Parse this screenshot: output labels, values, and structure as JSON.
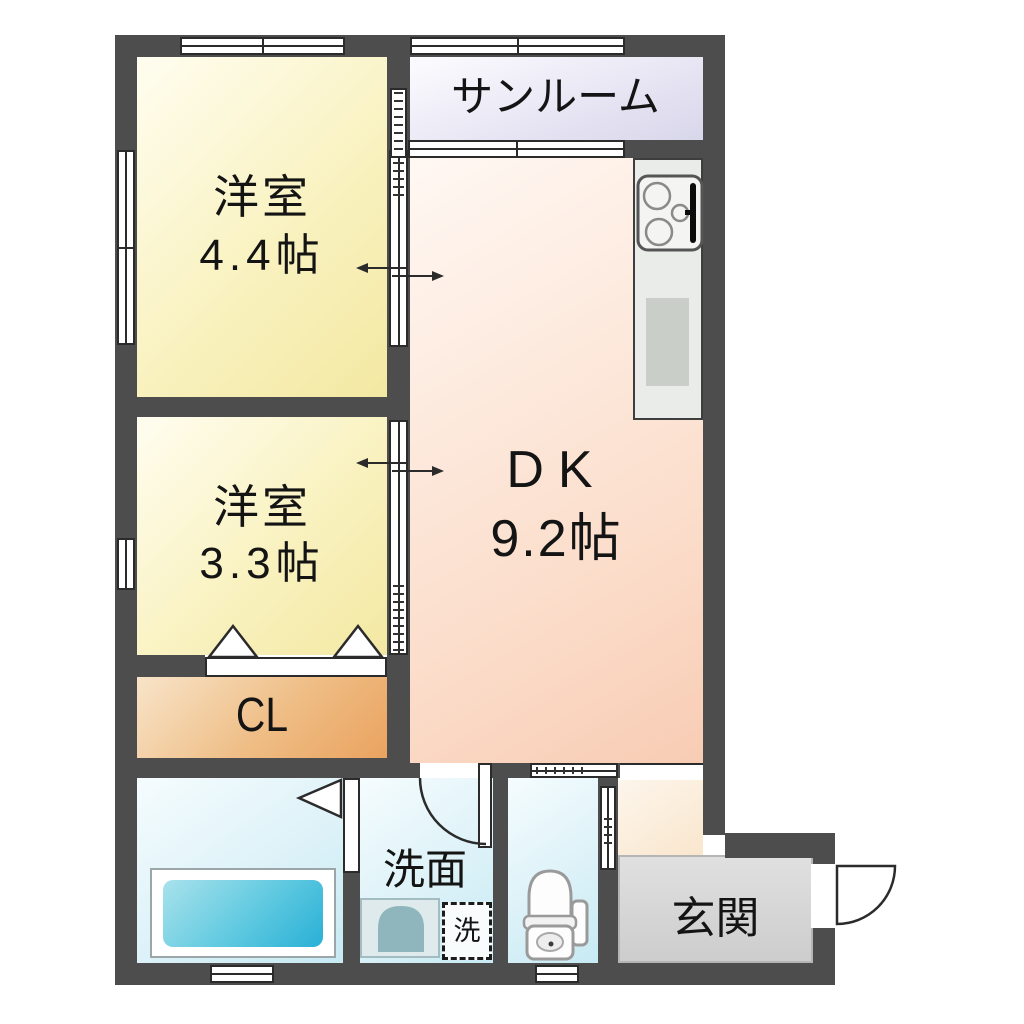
{
  "plan": {
    "kind": "apartment-floor-plan",
    "rooms": {
      "sunroom": {
        "name": "サンルーム"
      },
      "bedroom_1": {
        "name": "洋室",
        "area": "4.4帖"
      },
      "bedroom_2": {
        "name": "洋室",
        "area": "3.3帖"
      },
      "dining_kitchen": {
        "name": "DK",
        "area": "9.2帖"
      },
      "closet": {
        "name": "CL"
      },
      "washroom": {
        "name": "洗面"
      },
      "laundry_space": {
        "name": "洗"
      },
      "entrance": {
        "name": "玄関"
      }
    },
    "colors": {
      "wall": "#4d4d4d",
      "bedroom_fill": "#f3e8a2",
      "sunroom_fill": "#d8d6ea",
      "dk_fill": "#f8ccb4",
      "closet_fill": "#eaa35f",
      "wet_area_fill": "#c7eaf3",
      "bathtub_fill": "#29b0d6",
      "entrance_fill": "#cdcdcd",
      "hall_fill": "#f9e6cd"
    }
  }
}
